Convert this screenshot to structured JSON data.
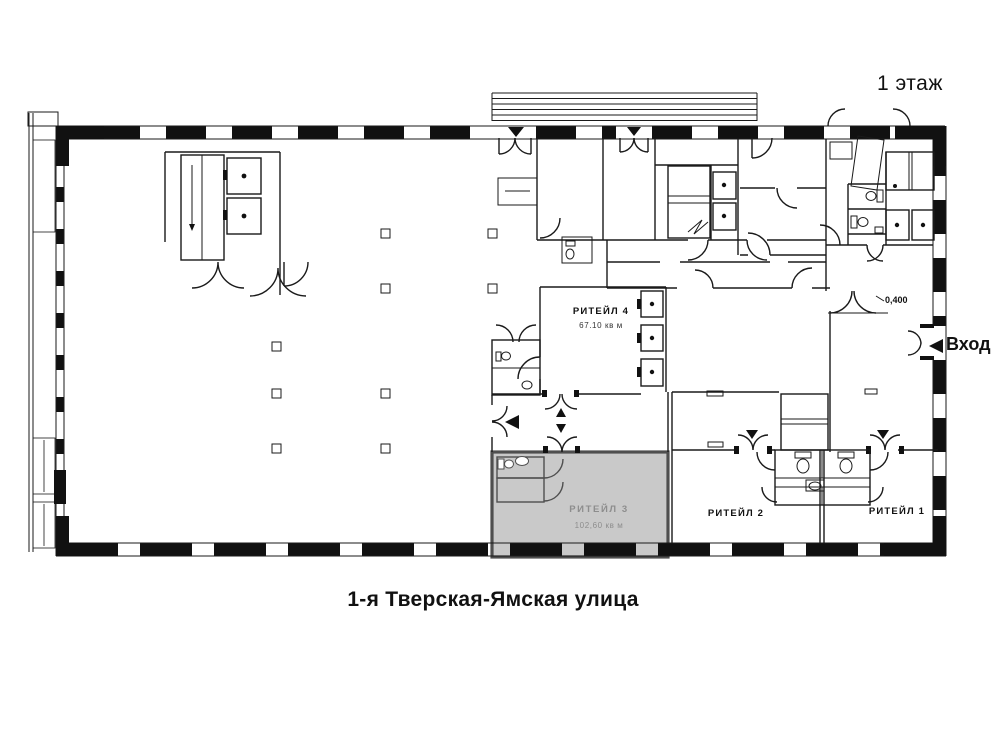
{
  "header": {
    "floor_label": "1 этаж"
  },
  "street": {
    "label": "1-я Тверская-Ямская улица"
  },
  "entrance": {
    "label": "Вход",
    "icon": "left-triangle-arrow"
  },
  "level_mark": {
    "value": "0,400"
  },
  "rooms": [
    {
      "id": "retail-4",
      "name": "РИТЕЙЛ 4",
      "area": "67.10 кв м",
      "highlighted": false
    },
    {
      "id": "retail-3",
      "name": "РИТЕЙЛ 3",
      "area": "102,60 кв м",
      "highlighted": true
    },
    {
      "id": "retail-2",
      "name": "РИТЕЙЛ 2",
      "area": "",
      "highlighted": false
    },
    {
      "id": "retail-1",
      "name": "РИТЕЙЛ 1",
      "area": "",
      "highlighted": false
    }
  ],
  "icons": {
    "entrance_arrow": "left-triangle",
    "door_in_marker": "down-triangle",
    "door_out_marker": "up-triangle"
  },
  "colors": {
    "line": "#1a1a1a",
    "highlight_fill": "#c9c9c9",
    "highlight_border": "#4f4f4f",
    "highlight_text": "#8d8d8d"
  }
}
